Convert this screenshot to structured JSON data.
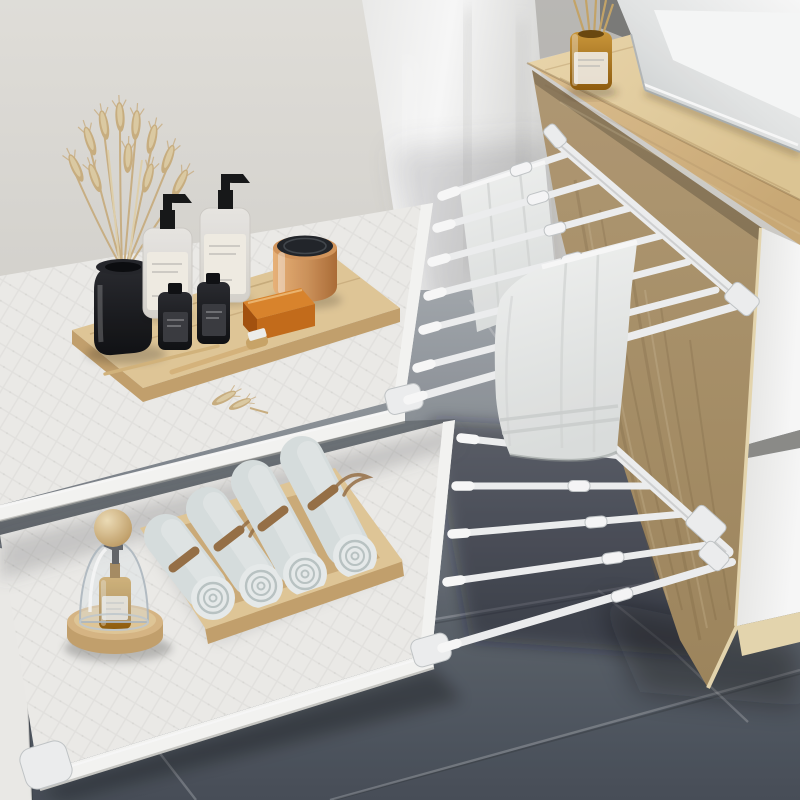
{
  "image_type": "product-lifestyle-photo",
  "description": "Bathroom scene: two white expandable telescoping storage shelves clamped to a light-wood vanity cabinet with a white vessel sink. Top shelf holds a wooden tray with toiletries, a black vase of dried wheat, a copper jar and amber soap; a white towel hangs on the top rod rack. Bottom shelf holds a glass cloche with an amber pump bottle and a wooden tray of four rolled towels tied with twine. Grey tile floor, light grey wall, white drawer fronts at right.",
  "counts": {
    "rods_top_rack": 6,
    "rods_bottom_rack": 4,
    "rolled_towels": 4,
    "drawers_visible": 2,
    "hanging_towels": 2
  },
  "palette": {
    "wall": "#e3e1dc",
    "wall_dark": "#aeadaa",
    "wall_corner": "#7e7e7c",
    "curtain_hi": "#ffffff",
    "curtain_lo": "#dededc",
    "floor_top": "#a6abb0",
    "floor_mid": "#8d939a",
    "floor_low": "#5f666f",
    "floor_dark": "#49505a",
    "seam_light": "#eef1f3",
    "wood_top": "#eed9ac",
    "wood_face": "#d9ba88",
    "wood_side": "#b29a74",
    "wood_trim": "#ecdcb4",
    "drawer_white": "#fafafa",
    "rack_white": "#f4f5f6",
    "rack_shadow": "#c6cacc",
    "shelf": "#f3f2ef",
    "shelf_edge": "#fbfbf9",
    "shelf_shadow": "#cdccc8",
    "towel": "#f2f3f2",
    "towel_shade": "#d8dbda",
    "roll": "#dde4e4",
    "roll_light": "#eef2f2",
    "roll_dark": "#bfc9c9",
    "twine": "#9b7348",
    "tray": "#e6cc9c",
    "tray_dark": "#d2b07c",
    "tray_face": "#c8a570",
    "glass_amber": "#b97e22",
    "amber_dark": "#8a5a12",
    "label": "#f7f3ea",
    "black_gloss": "#191a1e",
    "copper": "#d99a5e",
    "lid_black": "#23262b",
    "wheat": "#cfb384",
    "wheat_light": "#e2d1a8",
    "sink_face": "#c6cacb",
    "sink_white": "#fdfefe",
    "knob_wood": "#e6cda2",
    "base_wood": "#ddbb88"
  },
  "objects": [
    {
      "name": "wall",
      "description": "plain light grey wall"
    },
    {
      "name": "shower-curtain",
      "description": "soft white fabric panel left of cabinet"
    },
    {
      "name": "tile-floor",
      "description": "large grey tiles, darker toward foreground"
    },
    {
      "name": "vanity-cabinet",
      "description": "light wood bathroom cabinet"
    },
    {
      "name": "countertop",
      "description": "wooden counter slab"
    },
    {
      "name": "vessel-sink",
      "description": "white rectangular vessel basin"
    },
    {
      "name": "reed-diffuser",
      "description": "amber glass diffuser with reed sticks"
    },
    {
      "name": "drawer-unit",
      "description": "two white drawer fronts on right side"
    },
    {
      "name": "top-expandable-shelf",
      "description": "white textured shelf panel, upper"
    },
    {
      "name": "top-rod-rack",
      "description": "six white telescoping rods plus rail"
    },
    {
      "name": "hanging-towel-small",
      "description": "folded white towel on back rod"
    },
    {
      "name": "hanging-towel-large",
      "description": "large white towel draped over middle rod"
    },
    {
      "name": "wooden-tray-top",
      "description": "bamboo tray with toiletries"
    },
    {
      "name": "black-vase",
      "description": "glossy black cylinder vase"
    },
    {
      "name": "dried-wheat",
      "description": "bundle of dried wheat stems"
    },
    {
      "name": "pump-bottle-left",
      "description": "clear pump bottle, white label"
    },
    {
      "name": "pump-bottle-right",
      "description": "clear pump bottle, white label"
    },
    {
      "name": "small-black-bottle-1",
      "description": "small dark glass bottle"
    },
    {
      "name": "small-black-bottle-2",
      "description": "small dark glass bottle"
    },
    {
      "name": "copper-jar",
      "description": "rose-gold jar with black lid"
    },
    {
      "name": "amber-soap-bar",
      "description": "translucent amber soap block"
    },
    {
      "name": "wooden-toothbrush",
      "description": "bamboo toothbrush with white bristles"
    },
    {
      "name": "wheat-sprig",
      "description": "loose wheat spike on shelf"
    },
    {
      "name": "bottom-expandable-shelf",
      "description": "white textured shelf panel, lower"
    },
    {
      "name": "bottom-rod-rack",
      "description": "four white telescoping rods plus rail"
    },
    {
      "name": "glass-cloche",
      "description": "glass dome with wooden knob on round wood base"
    },
    {
      "name": "amber-pump-bottle",
      "description": "amber pump bottle inside cloche"
    },
    {
      "name": "towel-tray",
      "description": "wooden tray holding rolled towels"
    },
    {
      "name": "rolled-towels",
      "description": "four pale rolled towels tied with twine"
    },
    {
      "name": "wall-pillar",
      "description": "white wall edge at bottom left"
    }
  ]
}
